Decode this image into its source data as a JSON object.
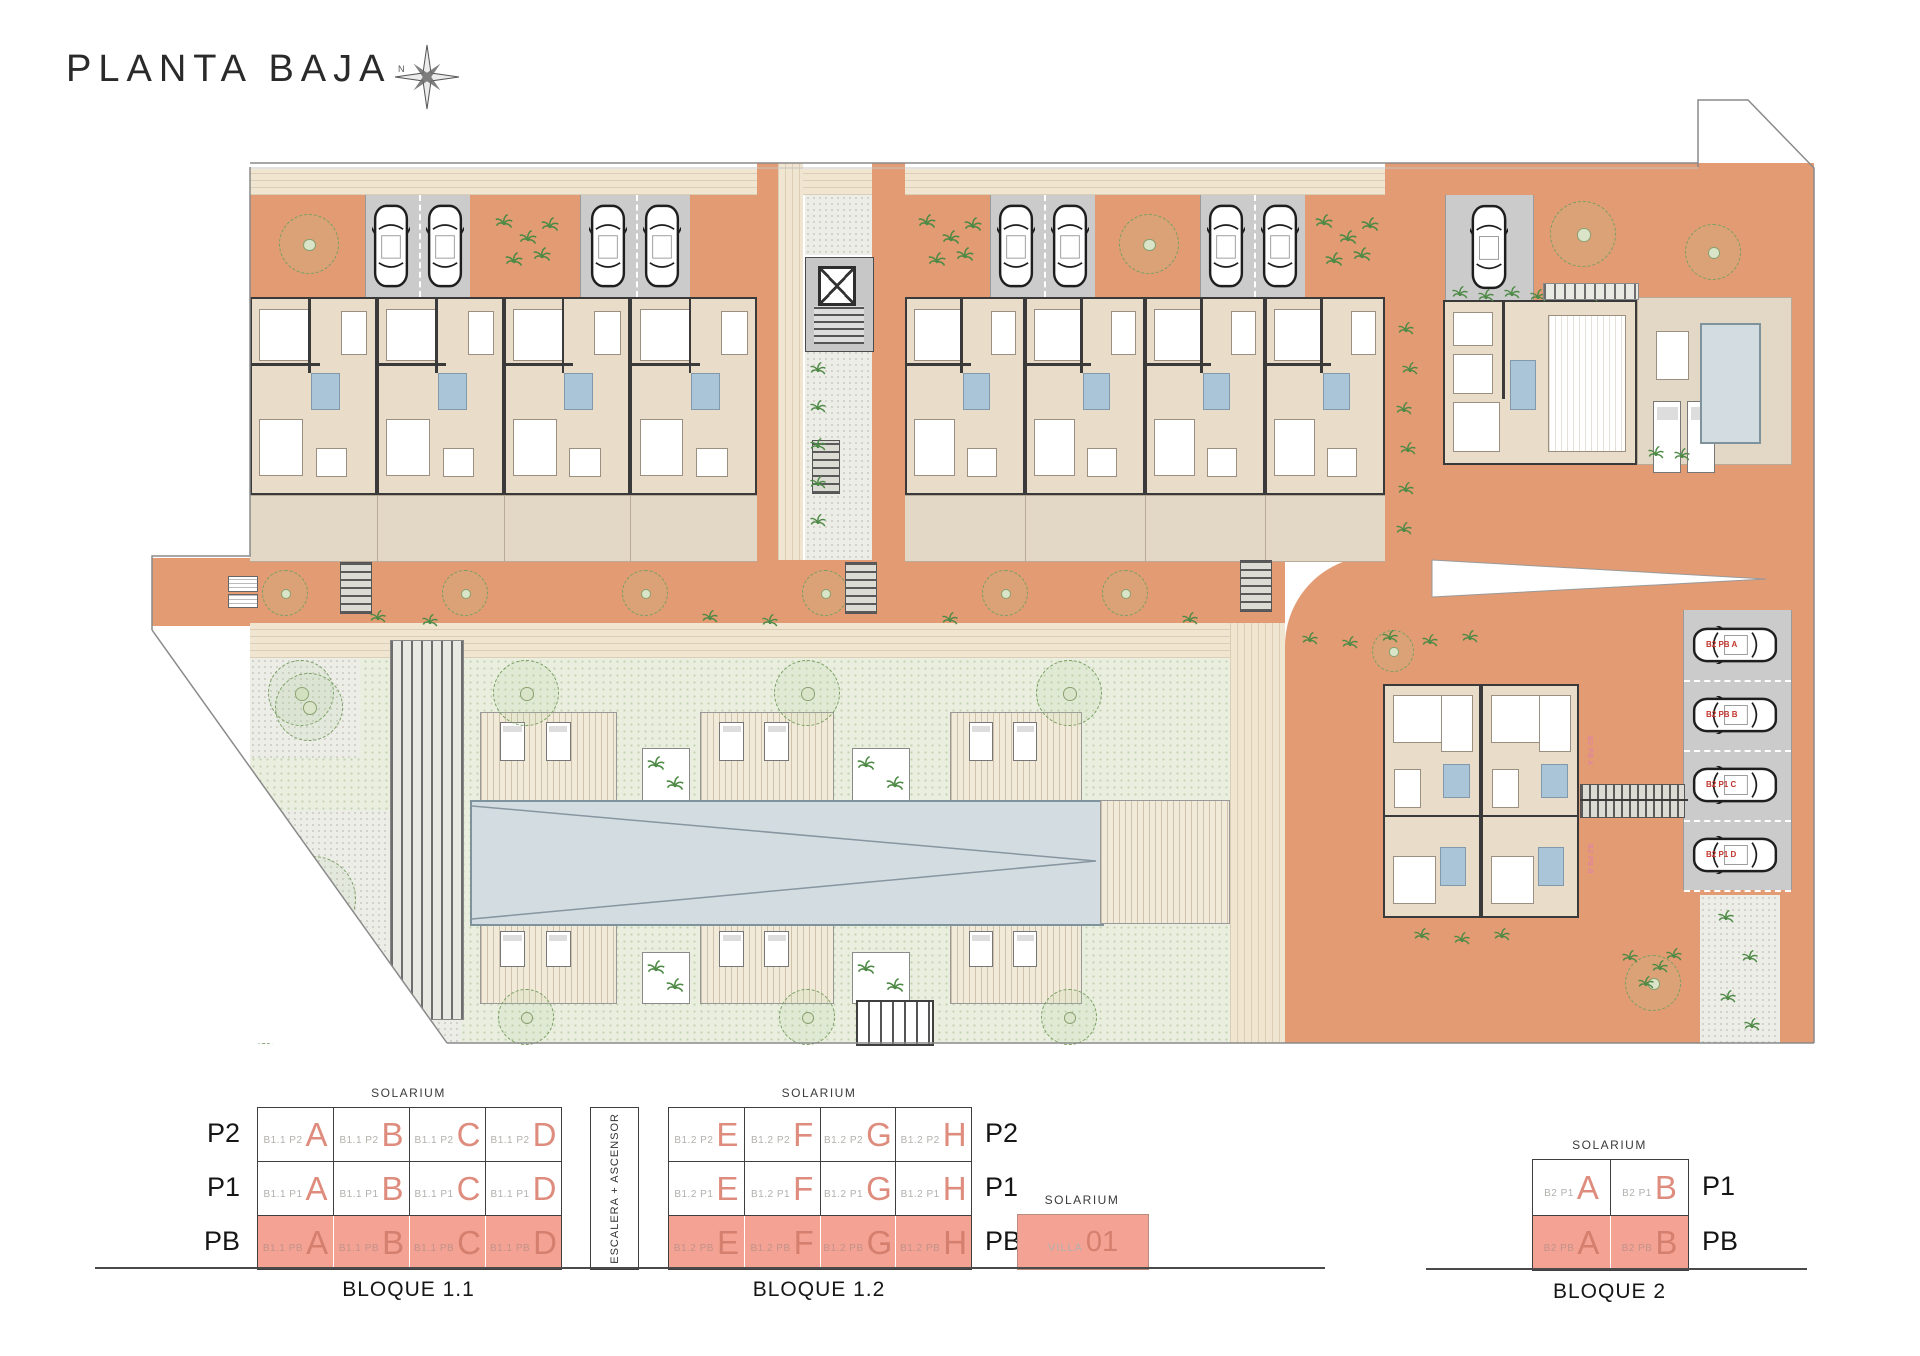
{
  "title": "PLANTA BAJA",
  "compass_label": "N",
  "colors": {
    "terracotta": "#e29b72",
    "beige": "#e9dcc9",
    "terrace": "#e3d7c5",
    "parking": "#cbcbcb",
    "garden": "#e9eede",
    "pool": "#d3dde1",
    "bath_blue": "#aac4d8",
    "salmon_fill": "#f3a294",
    "letter_salmon": "#de8c7d",
    "prefix_gray": "#b3b0ac",
    "label_red": "#c2342c",
    "label_pink": "#e27ab1"
  },
  "site_plan": {
    "parking_labels": [
      "B2 PB A",
      "B2 PB B",
      "B2 P1 C",
      "B2 P1 D"
    ],
    "building_unit_labels": [
      "B2 PB A",
      "B2 PB B"
    ]
  },
  "schematics": {
    "stair_label": "ESCALERA + ASCENSOR",
    "bloque11": {
      "name": "BLOQUE 1.1",
      "solarium_label": "SOLARIUM",
      "floors": [
        {
          "label": "P2",
          "filled": false,
          "cells": [
            {
              "prefix": "B1.1 P2",
              "letter": "A"
            },
            {
              "prefix": "B1.1 P2",
              "letter": "B"
            },
            {
              "prefix": "B1.1 P2",
              "letter": "C"
            },
            {
              "prefix": "B1.1 P2",
              "letter": "D"
            }
          ]
        },
        {
          "label": "P1",
          "filled": false,
          "cells": [
            {
              "prefix": "B1.1 P1",
              "letter": "A"
            },
            {
              "prefix": "B1.1 P1",
              "letter": "B"
            },
            {
              "prefix": "B1.1 P1",
              "letter": "C"
            },
            {
              "prefix": "B1.1 P1",
              "letter": "D"
            }
          ]
        },
        {
          "label": "PB",
          "filled": true,
          "cells": [
            {
              "prefix": "B1.1 PB",
              "letter": "A"
            },
            {
              "prefix": "B1.1 PB",
              "letter": "B"
            },
            {
              "prefix": "B1.1 PB",
              "letter": "C"
            },
            {
              "prefix": "B1.1 PB",
              "letter": "D"
            }
          ]
        }
      ]
    },
    "bloque12": {
      "name": "BLOQUE 1.2",
      "solarium_label": "SOLARIUM",
      "floors": [
        {
          "label": "P2",
          "filled": false,
          "cells": [
            {
              "prefix": "B1.2 P2",
              "letter": "E"
            },
            {
              "prefix": "B1.2 P2",
              "letter": "F"
            },
            {
              "prefix": "B1.2 P2",
              "letter": "G"
            },
            {
              "prefix": "B1.2 P2",
              "letter": "H"
            }
          ]
        },
        {
          "label": "P1",
          "filled": false,
          "cells": [
            {
              "prefix": "B1.2 P1",
              "letter": "E"
            },
            {
              "prefix": "B1.2 P1",
              "letter": "F"
            },
            {
              "prefix": "B1.2 P1",
              "letter": "G"
            },
            {
              "prefix": "B1.2 P1",
              "letter": "H"
            }
          ]
        },
        {
          "label": "PB",
          "filled": true,
          "cells": [
            {
              "prefix": "B1.2 PB",
              "letter": "E"
            },
            {
              "prefix": "B1.2 PB",
              "letter": "F"
            },
            {
              "prefix": "B1.2 PB",
              "letter": "G"
            },
            {
              "prefix": "B1.2 PB",
              "letter": "H"
            }
          ]
        }
      ]
    },
    "villa": {
      "solarium_label": "SOLARIUM",
      "floor_label": "PB",
      "prefix": "VILLA",
      "number": "01"
    },
    "bloque2": {
      "name": "BLOQUE 2",
      "solarium_label": "SOLARIUM",
      "floors": [
        {
          "label": "P1",
          "filled": false,
          "cells": [
            {
              "prefix": "B2 P1",
              "letter": "A"
            },
            {
              "prefix": "B2 P1",
              "letter": "B"
            }
          ]
        },
        {
          "label": "PB",
          "filled": true,
          "cells": [
            {
              "prefix": "B2 PB",
              "letter": "A"
            },
            {
              "prefix": "B2 PB",
              "letter": "B"
            }
          ]
        }
      ]
    }
  }
}
